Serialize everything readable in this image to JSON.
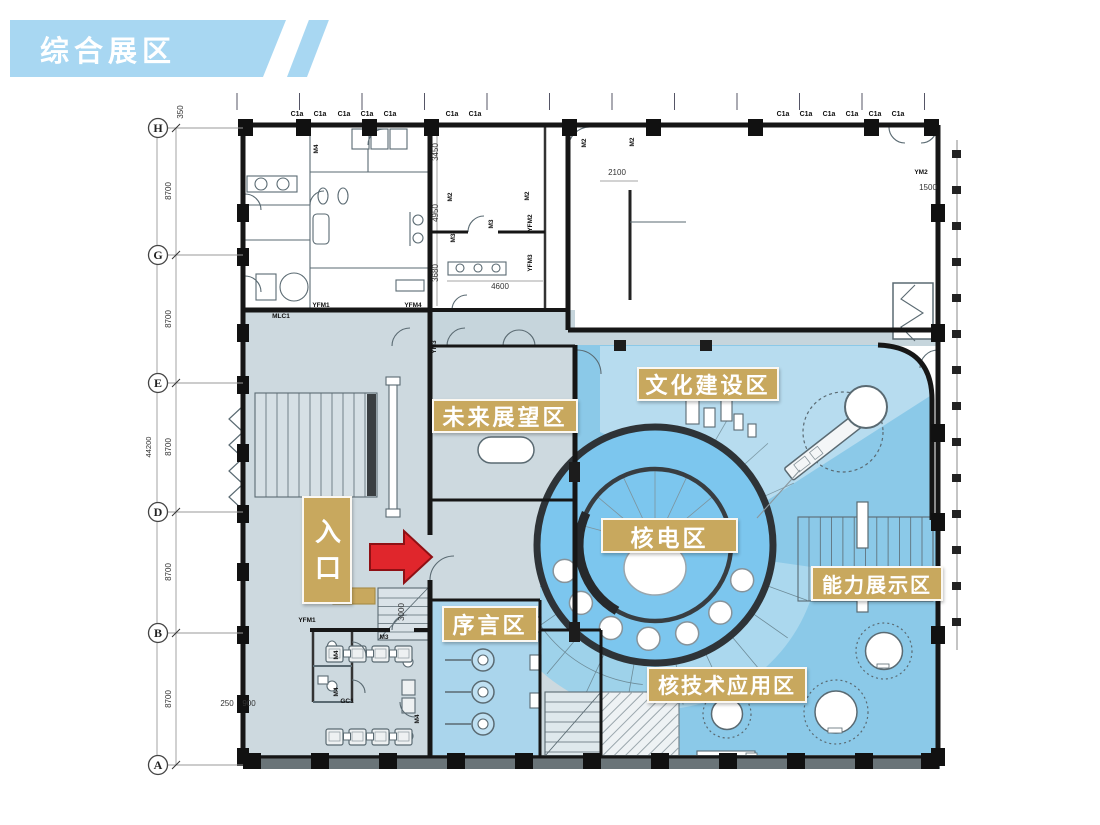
{
  "banner": {
    "title": "综合展区"
  },
  "colors": {
    "banner_blue": "#a8d7f2",
    "label_tan": "#c8a85e",
    "arrow_red": "#e0262c",
    "zone_gray": "#cdd9df",
    "zone_pale_blue": "#aad5ec",
    "zone_mid_blue": "#8bc9e8",
    "zone_bright_blue": "#7cc6ee",
    "zone_light_blue": "#b7dcef"
  },
  "plan": {
    "grid_rows": [
      {
        "letter": "H",
        "y": 128
      },
      {
        "letter": "G",
        "y": 255
      },
      {
        "letter": "E",
        "y": 383
      },
      {
        "letter": "D",
        "y": 512
      },
      {
        "letter": "B",
        "y": 633
      },
      {
        "letter": "A",
        "y": 765
      }
    ],
    "dim_labels": [
      {
        "text": "350",
        "x": 183,
        "y": 112,
        "rot": 1
      },
      {
        "text": "8700",
        "x": 171,
        "y": 191,
        "rot": 1
      },
      {
        "text": "8700",
        "x": 171,
        "y": 319,
        "rot": 1
      },
      {
        "text": "44200",
        "x": 151,
        "y": 447,
        "rot": 1
      },
      {
        "text": "8700",
        "x": 171,
        "y": 447,
        "rot": 1
      },
      {
        "text": "8700",
        "x": 171,
        "y": 572,
        "rot": 1
      },
      {
        "text": "8700",
        "x": 171,
        "y": 699,
        "rot": 1
      },
      {
        "text": "3450",
        "x": 438,
        "y": 152,
        "rot": 1
      },
      {
        "text": "4950",
        "x": 438,
        "y": 213,
        "rot": 1
      },
      {
        "text": "3680",
        "x": 438,
        "y": 273,
        "rot": 1
      },
      {
        "text": "4600",
        "x": 500,
        "y": 289,
        "rot": 0
      },
      {
        "text": "2100",
        "x": 617,
        "y": 175,
        "rot": 0
      },
      {
        "text": "1500",
        "x": 928,
        "y": 190,
        "rot": 0
      },
      {
        "text": "3000",
        "x": 404,
        "y": 612,
        "rot": 1
      },
      {
        "text": "250",
        "x": 227,
        "y": 706,
        "rot": 0
      },
      {
        "text": "900",
        "x": 249,
        "y": 706,
        "rot": 0
      }
    ],
    "window_code": "C1a",
    "window_code_xs": [
      297,
      320,
      344,
      367,
      390,
      452,
      475,
      783,
      806,
      829,
      852,
      875,
      898
    ],
    "door_codes": [
      {
        "text": "M4",
        "x": 318,
        "y": 149,
        "rot": 1
      },
      {
        "text": "M2",
        "x": 452,
        "y": 197,
        "rot": 1
      },
      {
        "text": "M2",
        "x": 529,
        "y": 196,
        "rot": 1
      },
      {
        "text": "M2",
        "x": 586,
        "y": 143,
        "rot": 1
      },
      {
        "text": "M2",
        "x": 634,
        "y": 142,
        "rot": 1
      },
      {
        "text": "M3",
        "x": 455,
        "y": 238,
        "rot": 1
      },
      {
        "text": "YFM2",
        "x": 532,
        "y": 223,
        "rot": 1
      },
      {
        "text": "YFM3",
        "x": 532,
        "y": 263,
        "rot": 1
      },
      {
        "text": "M3",
        "x": 493,
        "y": 224,
        "rot": 1
      },
      {
        "text": "MLC1",
        "x": 281,
        "y": 318,
        "rot": 0
      },
      {
        "text": "YFM1",
        "x": 321,
        "y": 307,
        "rot": 0
      },
      {
        "text": "YFM4",
        "x": 413,
        "y": 307,
        "rot": 0
      },
      {
        "text": "YM3",
        "x": 436,
        "y": 347,
        "rot": 1
      },
      {
        "text": "YM2",
        "x": 921,
        "y": 174,
        "rot": 0
      },
      {
        "text": "YFM1",
        "x": 307,
        "y": 622,
        "rot": 0
      },
      {
        "text": "M3",
        "x": 384,
        "y": 639,
        "rot": 0
      },
      {
        "text": "M4",
        "x": 338,
        "y": 655,
        "rot": 1
      },
      {
        "text": "M4",
        "x": 338,
        "y": 692,
        "rot": 1
      },
      {
        "text": "GC1",
        "x": 347,
        "y": 703,
        "rot": 0
      },
      {
        "text": "M4",
        "x": 419,
        "y": 719,
        "rot": 1
      }
    ],
    "zones": [
      {
        "id": "future",
        "label": "未来展望区"
      },
      {
        "id": "culture",
        "label": "文化建设区"
      },
      {
        "id": "nuclear",
        "label": "核电区"
      },
      {
        "id": "capability",
        "label": "能力展示区"
      },
      {
        "id": "preface",
        "label": "序言区"
      },
      {
        "id": "nuctech",
        "label": "核技术应用区"
      }
    ],
    "entrance_label": "入口"
  }
}
